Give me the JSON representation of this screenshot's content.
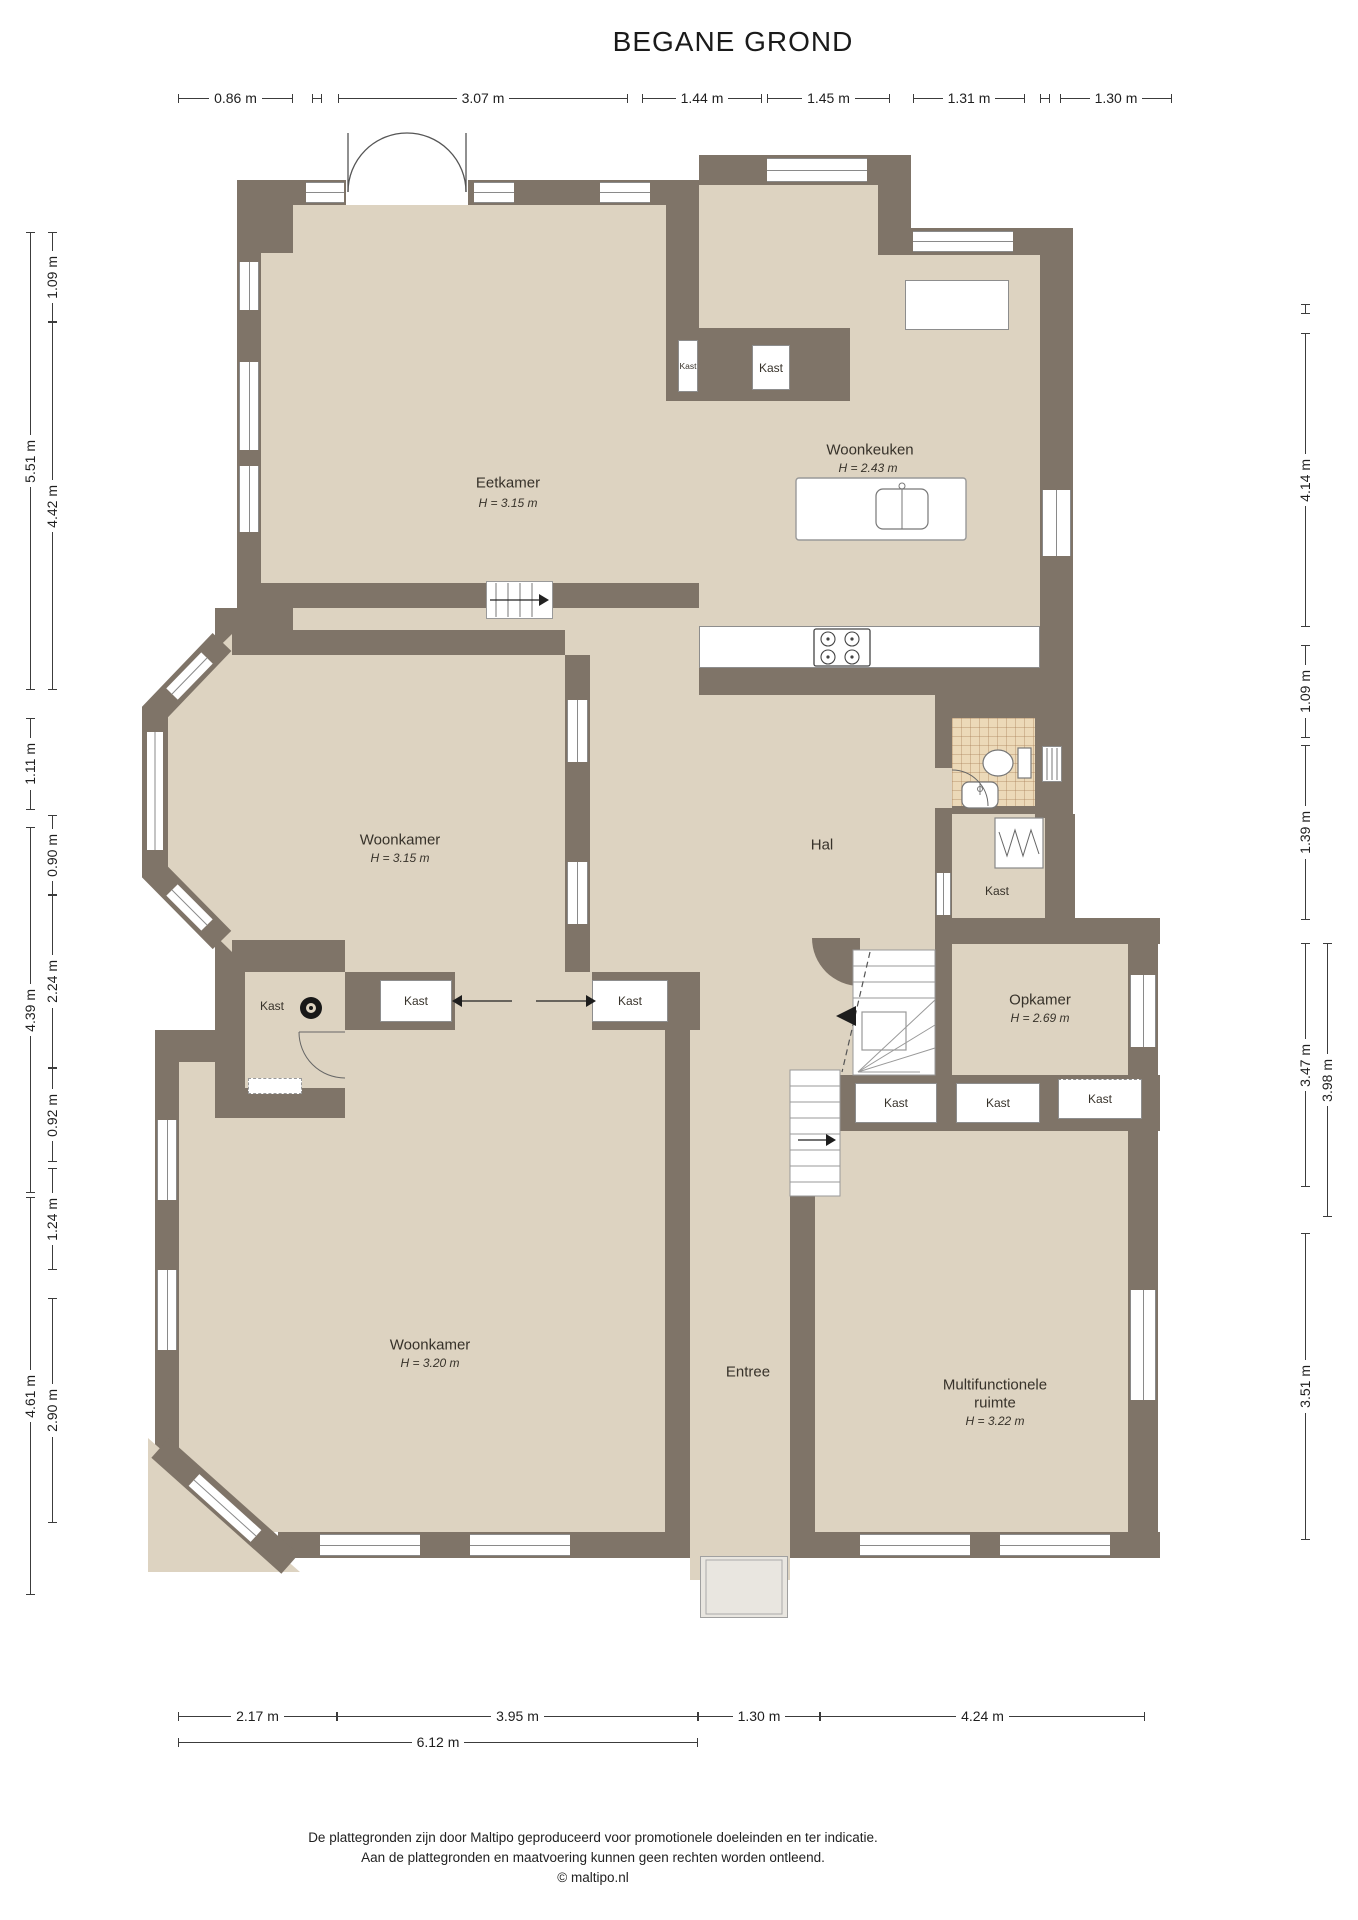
{
  "title": "BEGANE GROND",
  "floorplan": {
    "rooms": {
      "eetkamer": {
        "name": "Eetkamer",
        "ceiling": "H = 3.15 m"
      },
      "woonkeuken": {
        "name": "Woonkeuken",
        "ceiling": "H = 2.43 m"
      },
      "hal": {
        "name": "Hal"
      },
      "woonkamer_boven": {
        "name": "Woonkamer",
        "ceiling": "H = 3.15 m"
      },
      "opkamer": {
        "name": "Opkamer",
        "ceiling": "H = 2.69 m"
      },
      "entree": {
        "name": "Entree"
      },
      "woonkamer_onder": {
        "name": "Woonkamer",
        "ceiling": "H = 3.20 m"
      },
      "multifunctionele_ruimte": {
        "name_line1": "Multifunctionele",
        "name_line2": "ruimte",
        "ceiling": "H = 3.22 m"
      }
    },
    "closet_label": "Kast",
    "colors": {
      "wall": "#7f7468",
      "floor": "#ddd3c1",
      "tile": "#ecd9b8",
      "background": "#ffffff"
    }
  },
  "dimensions": {
    "top": [
      "0.86 m",
      "3.07 m",
      "1.44 m",
      "1.45 m",
      "1.31 m",
      "1.30 m"
    ],
    "left_outer": [
      "5.51 m",
      "1.11 m",
      "4.39 m",
      "4.61 m"
    ],
    "left_inner": [
      "1.09 m",
      "4.42 m",
      "0.90 m",
      "2.24 m",
      "0.92 m",
      "1.24 m",
      "2.90 m"
    ],
    "right_inner": [
      "4.14 m",
      "1.09 m",
      "1.39 m",
      "3.47 m",
      "3.51 m"
    ],
    "right_outer": [
      "3.98 m"
    ],
    "bottom": [
      "2.17 m",
      "3.95 m",
      "1.30 m",
      "4.24 m"
    ],
    "bottom_total": [
      "6.12 m"
    ]
  },
  "footer": {
    "line1": "De plattegronden zijn door Maltipo geproduceerd voor promotionele doeleinden en ter indicatie.",
    "line2": "Aan de plattegronden en maatvoering kunnen geen rechten worden ontleend.",
    "line3": "© maltipo.nl"
  }
}
